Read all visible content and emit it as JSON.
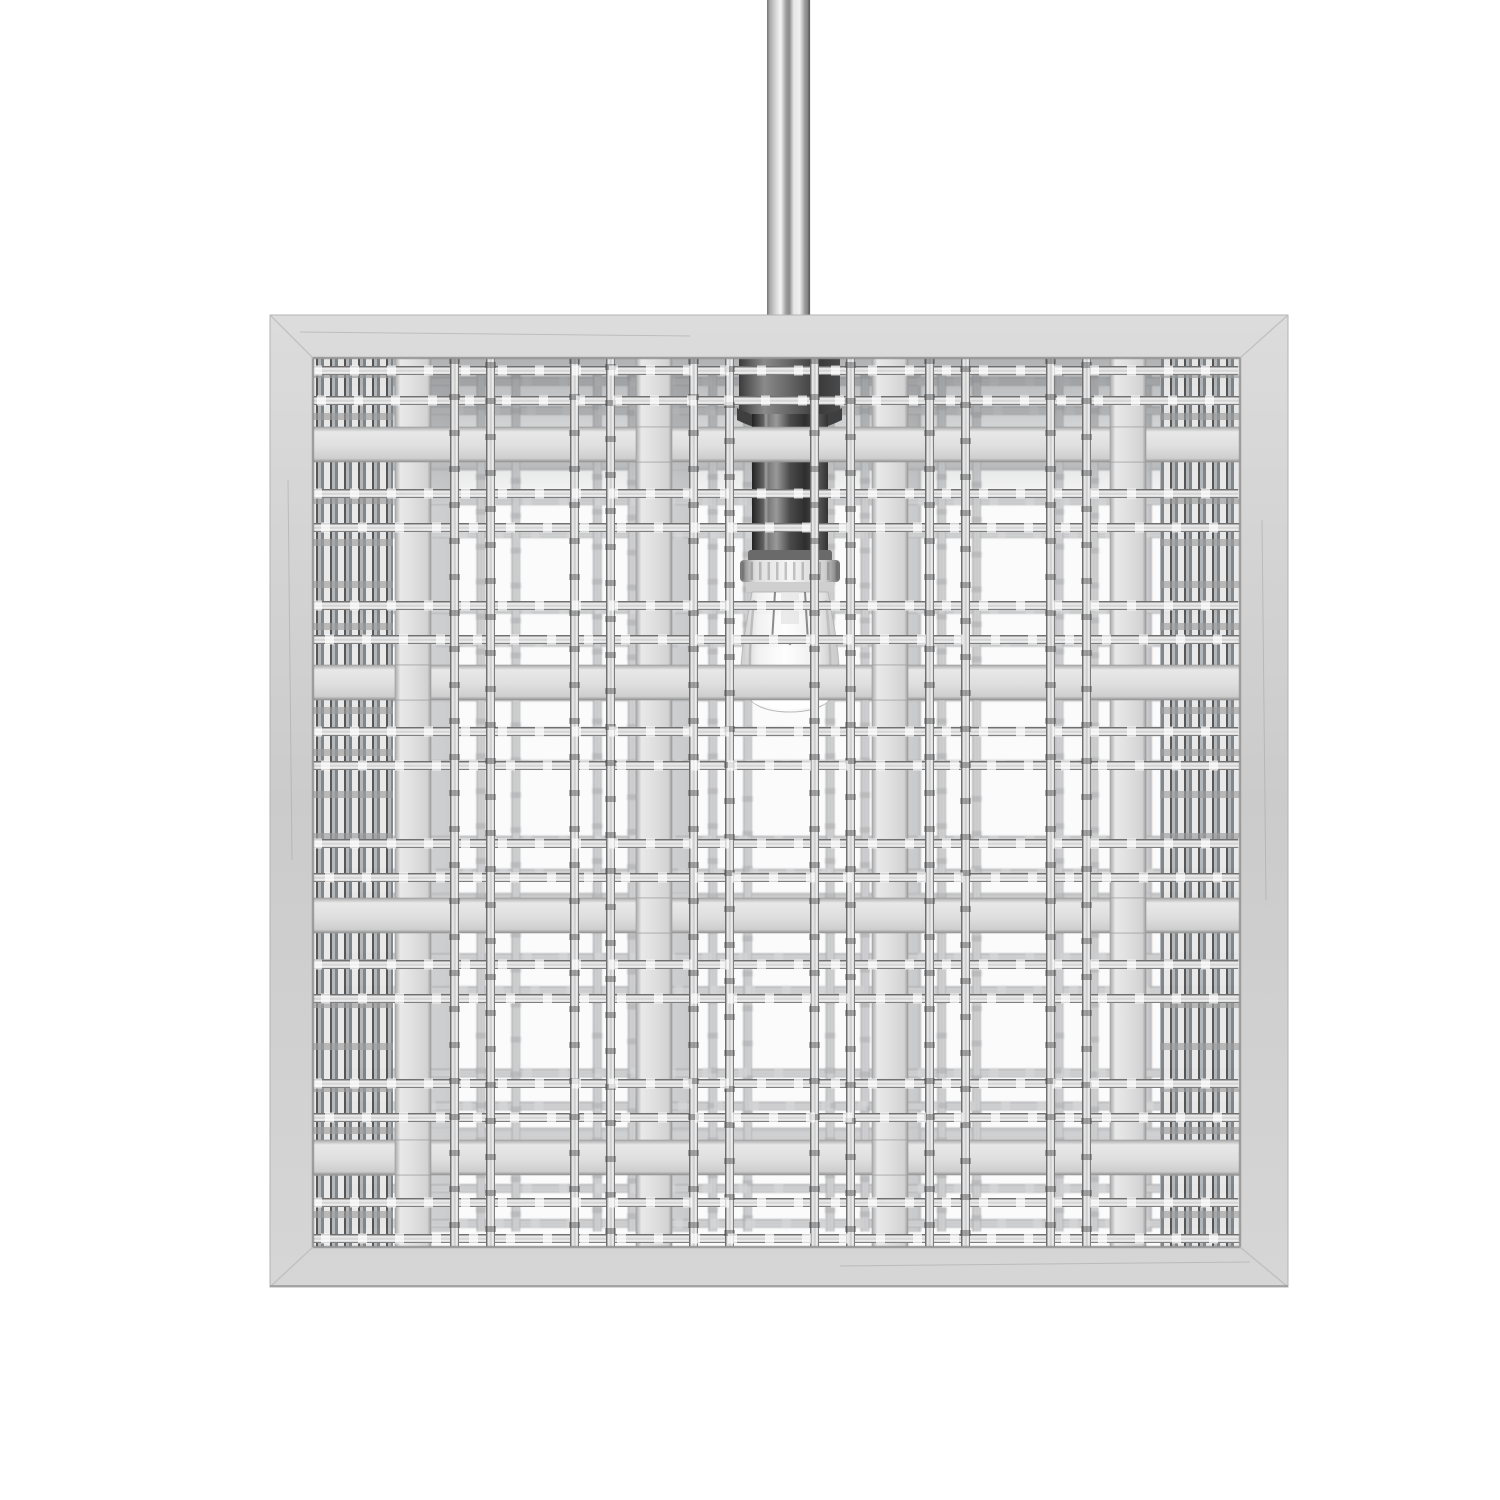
{
  "scene": {
    "title": "Brushed nickel square woven-cage pendant light",
    "description": "Product photo of a square open-cage pendant light: a plaid basket weave of wide flat brushed bands and paired thin square wires inside a square nickel frame, with an exposed clear bulb on a dark center socket stem, hanging from a straight round downrod on a plain white background",
    "background": "#ffffff"
  },
  "fixture": {
    "rod": "straight round downrod, brushed nickel",
    "frame": "square brushed-nickel picture frame border",
    "weave": "plaid weave: wide flat bands crossing pairs of thin square wires",
    "wide_vertical_bands": 4,
    "wide_horizontal_bands": 4,
    "thin_vertical_wires": 12,
    "thin_horizontal_wires": 16,
    "socket": "dark cylindrical socket stem with knurled bright ring",
    "bulb": "clear glass bulb, unlit"
  },
  "colors": {
    "background": "#ffffff",
    "interior": "#fbfbfb",
    "frame": "#d2d2d2",
    "band": "#e2e2e2",
    "wire_highlight": "#f2f2f2",
    "wire_edge": "#4f4f4f",
    "back_weave": "#8b9093",
    "socket": "#3a3a3a",
    "ring": "#e8e8e8",
    "bulb_glass": "#f4f4f4"
  }
}
